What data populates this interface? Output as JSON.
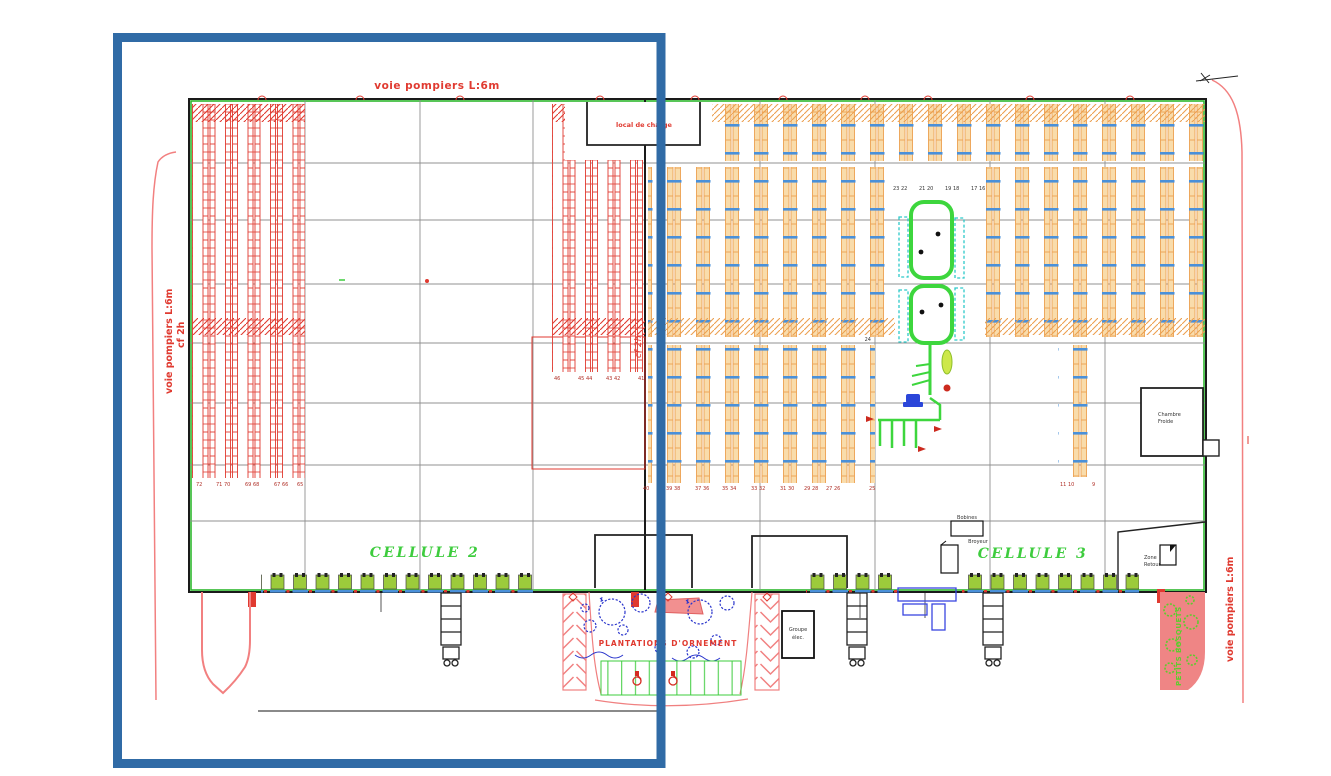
{
  "plan": {
    "title_context": "warehouse floor plan",
    "labels": {
      "fire_lane_top": "voie pompiers L:6m",
      "fire_lane_left_line1": "voie pompiers L:6m",
      "fire_lane_left_line2": "cf 2h",
      "fire_lane_right": "voie pompiers L:6m",
      "firewall_note": "cf 2h",
      "charge_room": "local de charge",
      "cold_room_line1": "Chambre",
      "cold_room_line2": "Froide",
      "zone_retour_line1": "Zone",
      "zone_retour_line2": "Retour",
      "bobines": "Bobines",
      "broyeur": "Broyeur",
      "generator_line1": "Groupe",
      "generator_line2": "élec.",
      "cell2": "CELLULE 2",
      "cell3": "CELLULE 3",
      "plantations": "PLANTATIONS D'ORNEMENT",
      "bosquets": "PETITS BOSQUETS"
    },
    "rack_numbers": {
      "left": [
        "72",
        "71 70",
        "69 68",
        "67 66",
        "65"
      ],
      "mid": [
        "46",
        "45 44",
        "43 42",
        "41"
      ],
      "center": [
        "40",
        "39 38",
        "37 36",
        "35 34",
        "33 32",
        "31 30",
        "29 28",
        "27 26",
        "25"
      ],
      "right": [
        "11 10",
        "9"
      ],
      "conveyor_cols": [
        "23 22",
        "21 20",
        "19 18",
        "17 16"
      ],
      "aisle_marker": "24"
    },
    "colors": {
      "highlight_box": "#306ba6",
      "rack_red": "#e03a30",
      "rack_orange": "#eca050",
      "beam_blue": "#4a90d9",
      "building_green": "#2eb82e",
      "conveyor_green": "#3dd63d",
      "cyan_accent": "#2cc9c9",
      "plant_blue": "#2a35cc",
      "site_red": "#f28080",
      "dock_green": "#9ccb3b",
      "bosquet_pink": "#ef8585"
    }
  }
}
